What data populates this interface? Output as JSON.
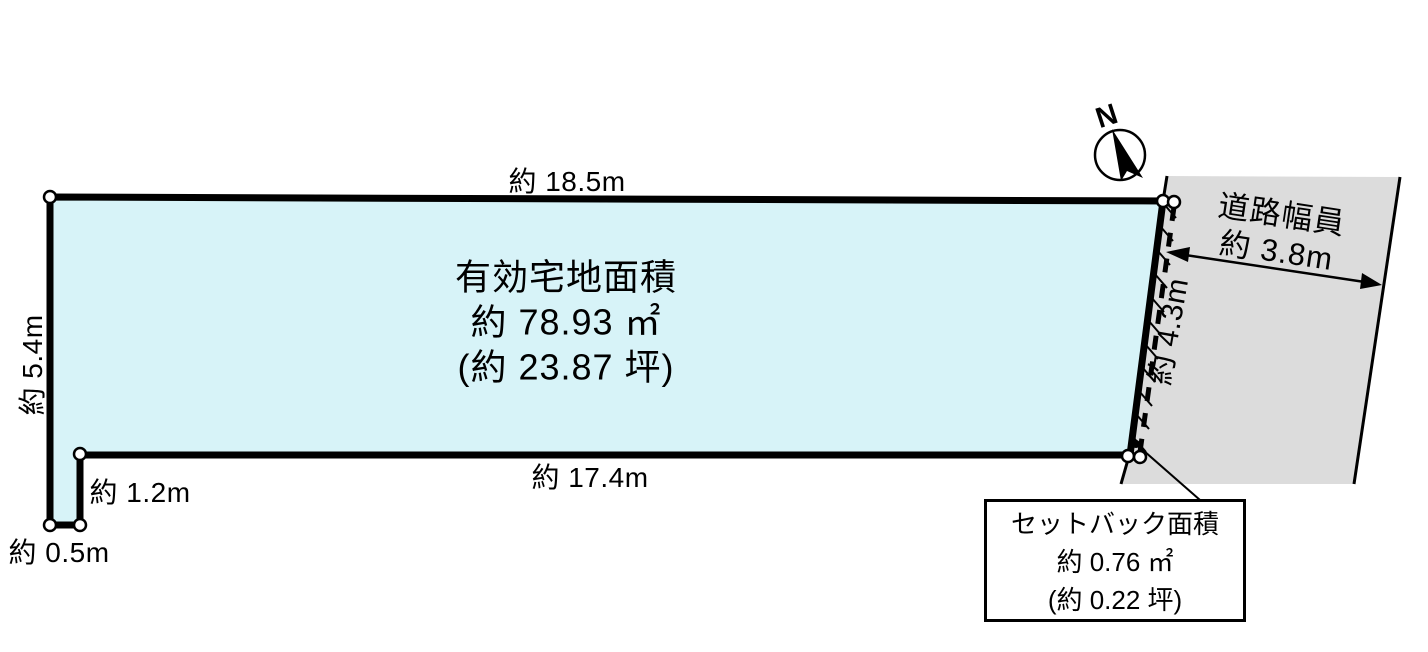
{
  "diagram": {
    "colors": {
      "parcel_fill": "#d7f3f8",
      "road_fill": "#dcdcdc",
      "outline": "#000000"
    },
    "compass": {
      "north_label": "N"
    },
    "parcel": {
      "area_line1": "有効宅地面積",
      "area_line2": "約 78.93 ㎡",
      "area_line3": "(約 23.87 坪)",
      "dim_top": "約 18.5m",
      "dim_bottom": "約 17.4m",
      "dim_left": "約 5.4m",
      "dim_right": "約 4.3m",
      "dim_notch_vertical": "約 1.2m",
      "dim_notch_bottom": "約 0.5m"
    },
    "road": {
      "label_line1": "道路幅員",
      "label_line2": "約 3.8m"
    },
    "setback_box": {
      "line1": "セットバック面積",
      "line2": "約 0.76 ㎡",
      "line3": "(約 0.22 坪)"
    }
  }
}
